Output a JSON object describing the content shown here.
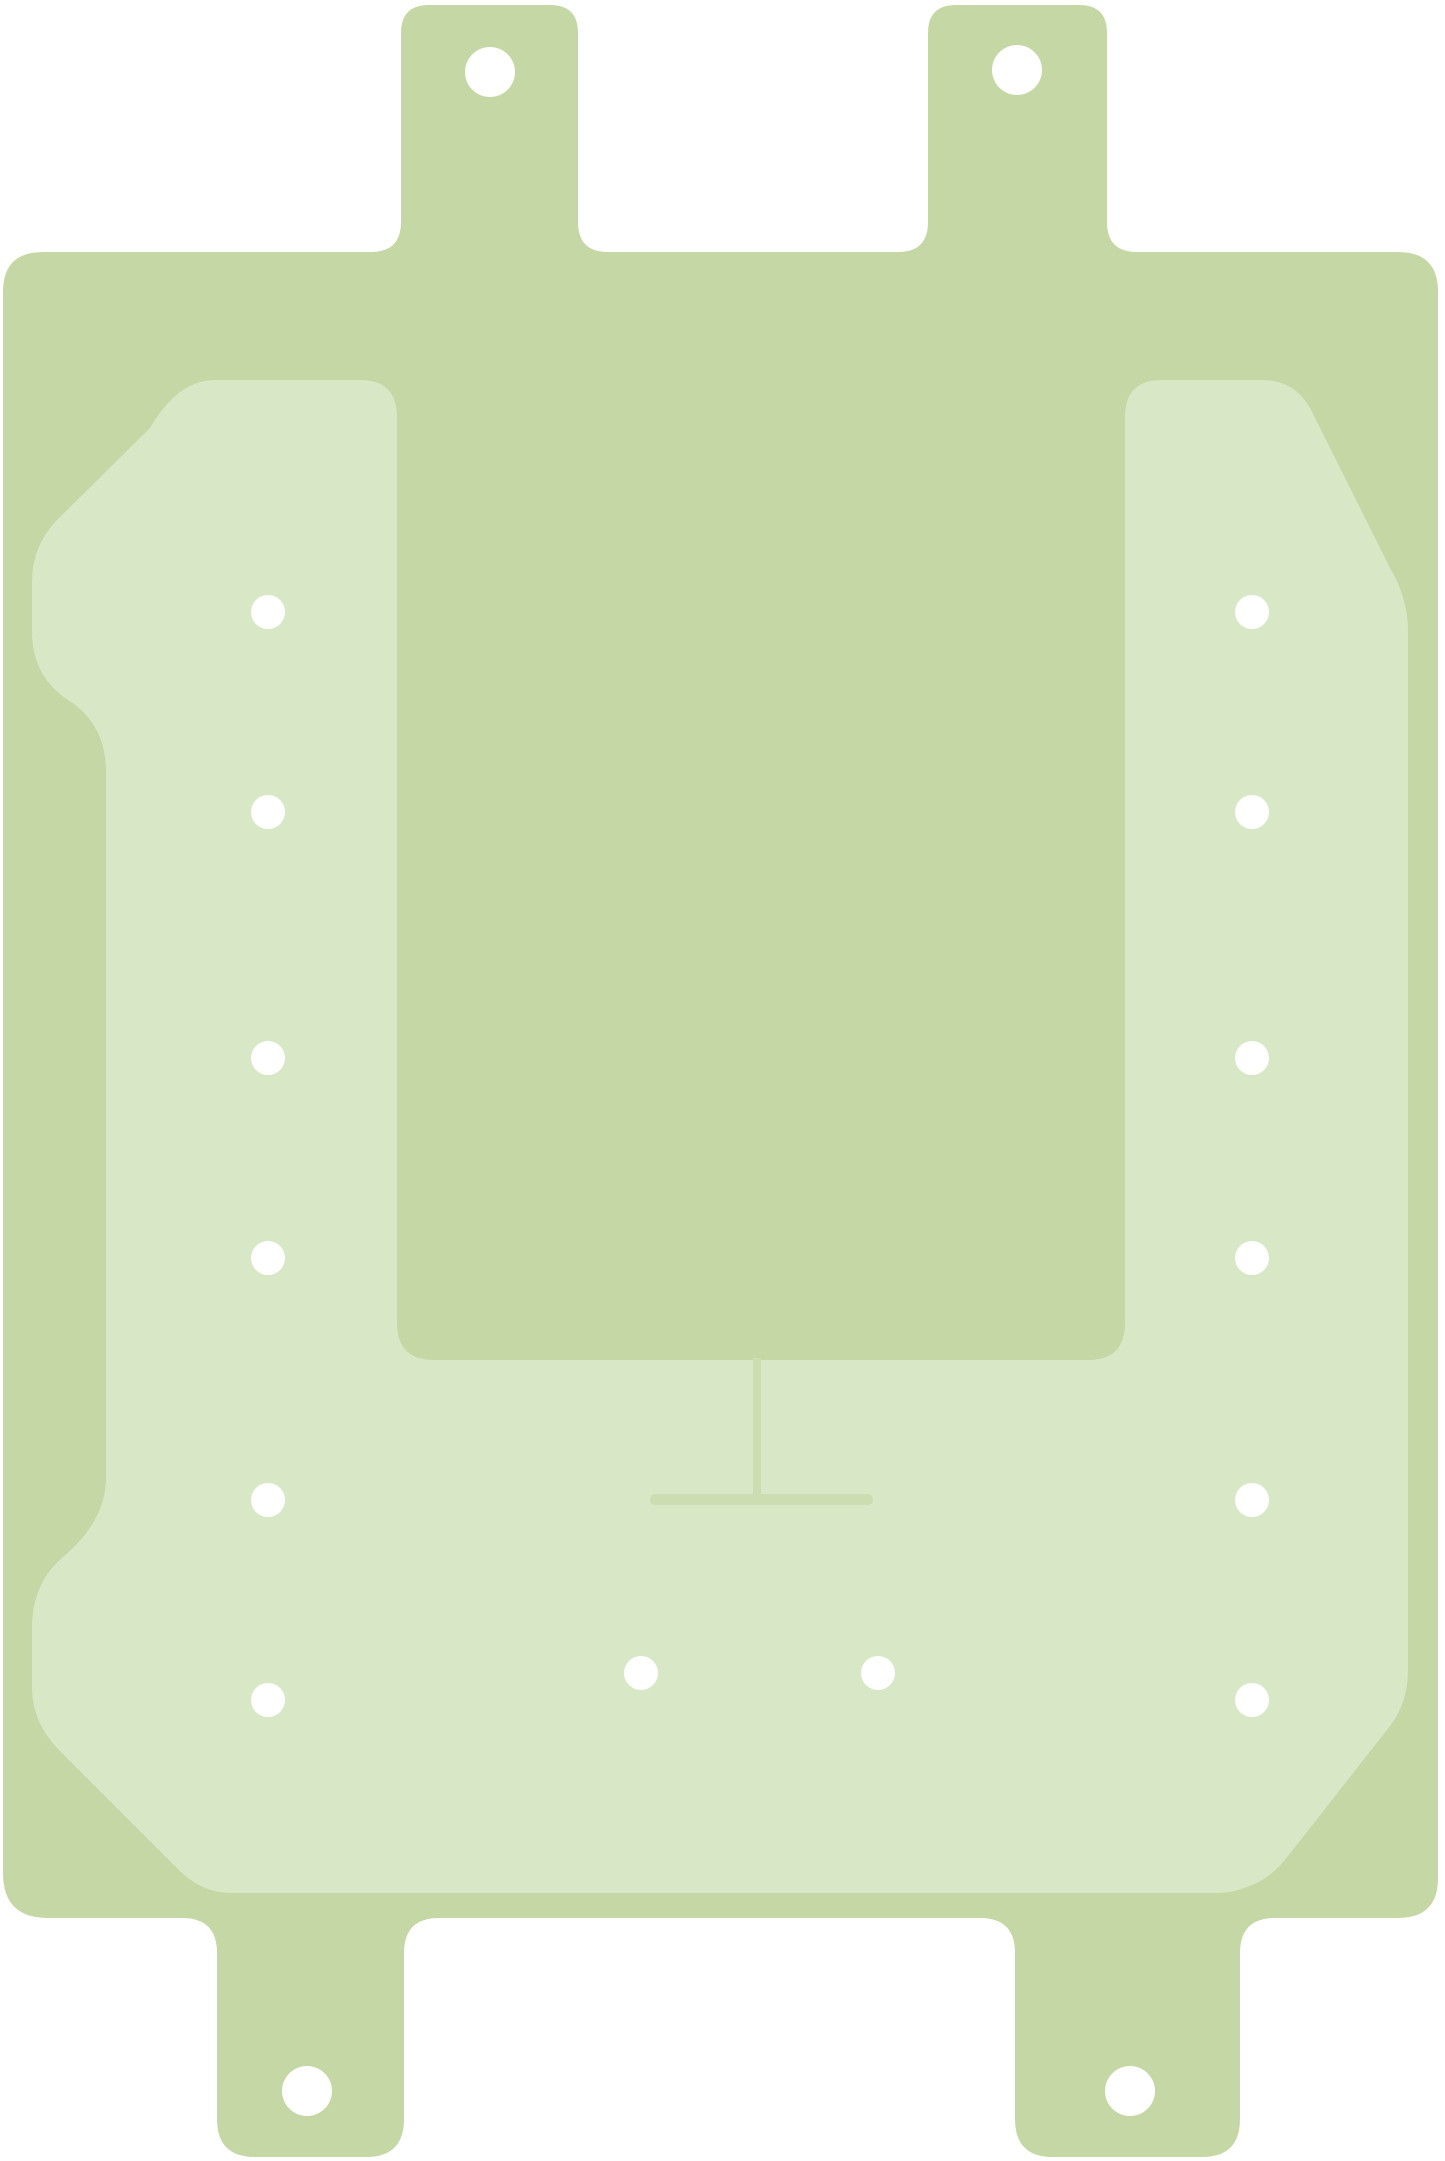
{
  "scene": {
    "description": "Die-cut adhesive gasket sheet with mounting tabs and punch holes on white background",
    "background_color": "#ffffff"
  },
  "colors": {
    "body": "#c5d7a4",
    "inner": "#d8e8c6",
    "lines": "#ccddb1",
    "holes": "#ffffff",
    "background": "#ffffff"
  },
  "geometry": {
    "canvas": {
      "width": 1445,
      "height": 2161
    },
    "small_holes": {
      "r": 17,
      "points": [
        [
          268,
          612
        ],
        [
          268,
          812
        ],
        [
          268,
          1058
        ],
        [
          268,
          1258
        ],
        [
          268,
          1500
        ],
        [
          268,
          1700
        ],
        [
          1252,
          612
        ],
        [
          1252,
          812
        ],
        [
          1252,
          1058
        ],
        [
          1252,
          1258
        ],
        [
          1252,
          1500
        ],
        [
          1252,
          1700
        ],
        [
          641,
          1673
        ],
        [
          878,
          1673
        ]
      ]
    },
    "tab_holes": {
      "r": 25,
      "points": [
        [
          490,
          72
        ],
        [
          1017,
          70
        ],
        [
          307,
          2091
        ],
        [
          1130,
          2091
        ]
      ]
    }
  }
}
